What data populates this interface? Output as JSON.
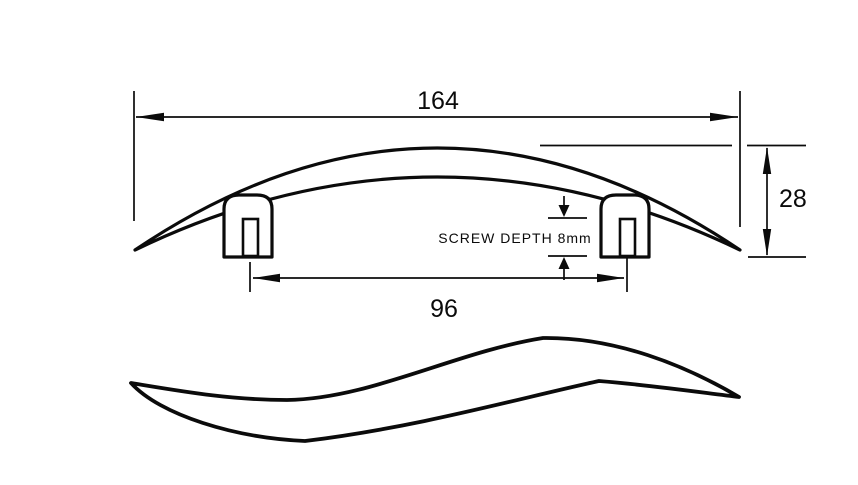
{
  "page": {
    "background_color": "#ffffff",
    "line_color": "#0b0b0b"
  },
  "drawing": {
    "dimensions": {
      "overall_length": "164",
      "fixing_centres": "96",
      "height": "28"
    },
    "notes": {
      "screw_depth": "SCREW DEPTH 8mm"
    }
  }
}
